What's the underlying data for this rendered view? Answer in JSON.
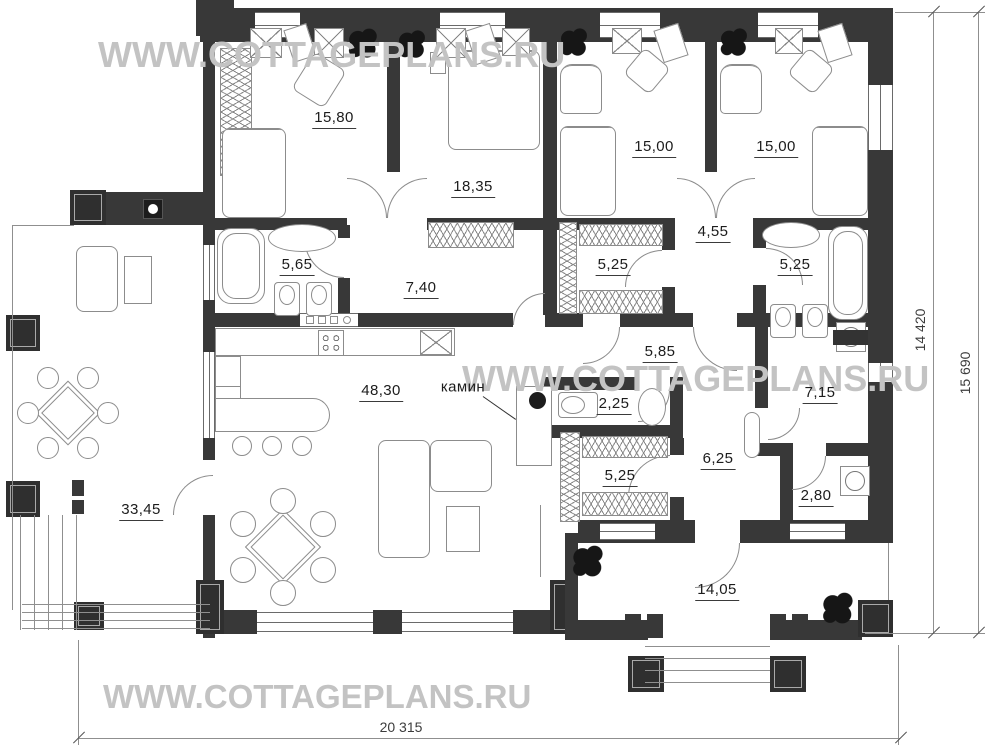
{
  "watermark": {
    "text": "WWW.COTTAGEPLANS.RU"
  },
  "rooms": {
    "bedroom_top_left": {
      "area": "15,80"
    },
    "bedroom_master": {
      "area": "18,35"
    },
    "bedroom_mid": {
      "area": "15,00"
    },
    "bedroom_right": {
      "area": "15,00"
    },
    "bathroom_left": {
      "area": "5,65"
    },
    "hall_top": {
      "area": "7,40"
    },
    "wardrobe_top": {
      "area": "5,25"
    },
    "hall_bedrooms": {
      "area": "4,55"
    },
    "bathroom_right": {
      "area": "5,25"
    },
    "corridor": {
      "area": "5,85"
    },
    "living_kitchen": {
      "area": "48,30"
    },
    "bathroom_small": {
      "area": "2,25"
    },
    "storage": {
      "area": "7,15"
    },
    "wardrobe_bottom": {
      "area": "5,25"
    },
    "entry_hall": {
      "area": "6,25"
    },
    "laundry": {
      "area": "2,80"
    },
    "terrace": {
      "area": "33,45"
    },
    "porch": {
      "area": "14,05"
    }
  },
  "labels": {
    "fireplace": "камин"
  },
  "dimensions": {
    "bottom_width": "20 315",
    "right_inner_height": "14 420",
    "right_outer_height": "15 690"
  },
  "colors": {
    "wall": "#383838",
    "watermark": "#c3c3c3",
    "line": "#8f8f8f"
  }
}
